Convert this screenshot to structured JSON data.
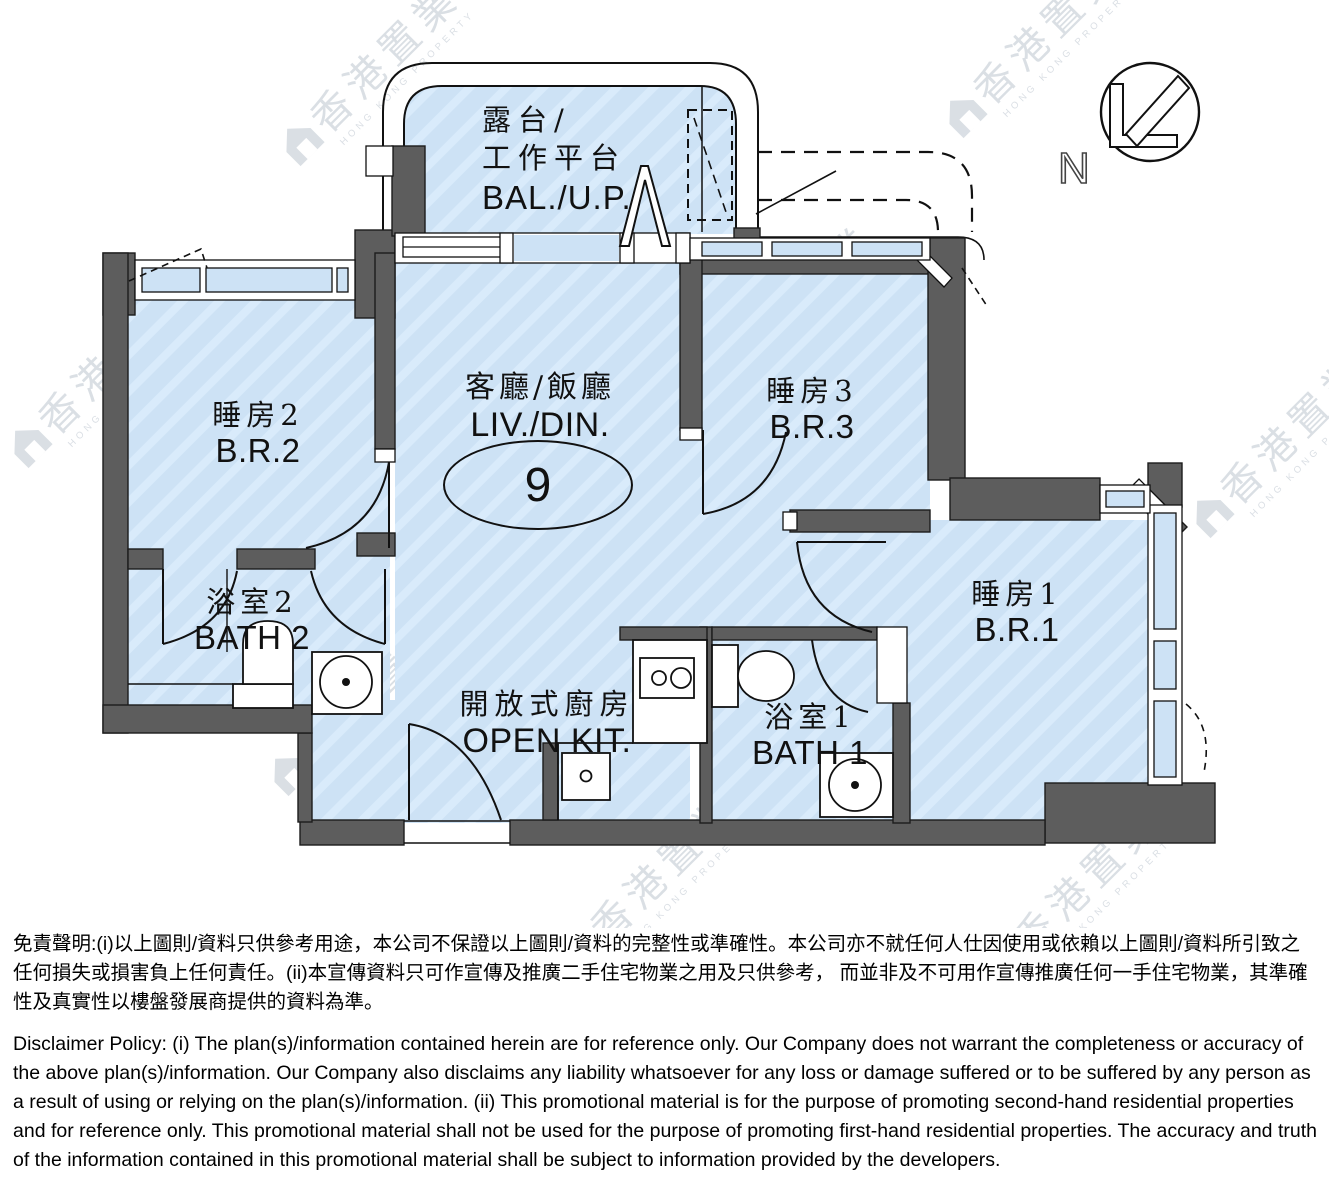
{
  "rooms": {
    "balcony": {
      "zh1": "露台/",
      "zh2": "工作平台",
      "en": "BAL./U.P."
    },
    "living_dining": {
      "zh": "客廳/飯廳",
      "en": "LIV./DIN."
    },
    "bedroom2": {
      "zh": "睡房2",
      "en": "B.R.2"
    },
    "bedroom3": {
      "zh": "睡房3",
      "en": "B.R.3"
    },
    "bedroom1": {
      "zh": "睡房1",
      "en": "B.R.1"
    },
    "bath2": {
      "zh": "浴室2",
      "en": "BATH 2"
    },
    "bath1": {
      "zh": "浴室1",
      "en": "BATH 1"
    },
    "kitchen": {
      "zh": "開放式廚房",
      "en": "OPEN KIT."
    }
  },
  "unit": {
    "number": "9"
  },
  "compass": {
    "label": "N"
  },
  "watermark": {
    "zh": "香港置業",
    "en": "HONG KONG PROPERTY"
  },
  "disclaimer": {
    "zh": "免責聲明:(i)以上圖則/資料只供參考用途，本公司不保證以上圖則/資料的完整性或準確性。本公司亦不就任何人仕因使用或依賴以上圖則/資料所引致之任何損失或損害負上任何責任。(ii)本宣傳資料只可作宣傳及推廣二手住宅物業之用及只供參考， 而並非及不可用作宣傳推廣任何一手住宅物業，其準確性及真實性以樓盤發展商提供的資料為準。",
    "en": "Disclaimer Policy: (i) The plan(s)/information contained herein are for reference only. Our Company does not warrant the completeness or accuracy of the above plan(s)/information. Our Company also disclaims any liability whatsoever for any loss or damage suffered or to be suffered by any person as a result of using or relying on the plan(s)/information. (ii) This promotional material is for the purpose of promoting second-hand residential properties and for reference only. This promotional material shall not be used for the purpose of promoting first-hand residential properties. The accuracy and truth of the information contained in this promotional material shall be subject to information provided by the developers."
  },
  "colors": {
    "room_fill": "#cde2f5",
    "wall": "#5d5d5d",
    "line": "#111111",
    "watermark": "#bcc5cf"
  }
}
